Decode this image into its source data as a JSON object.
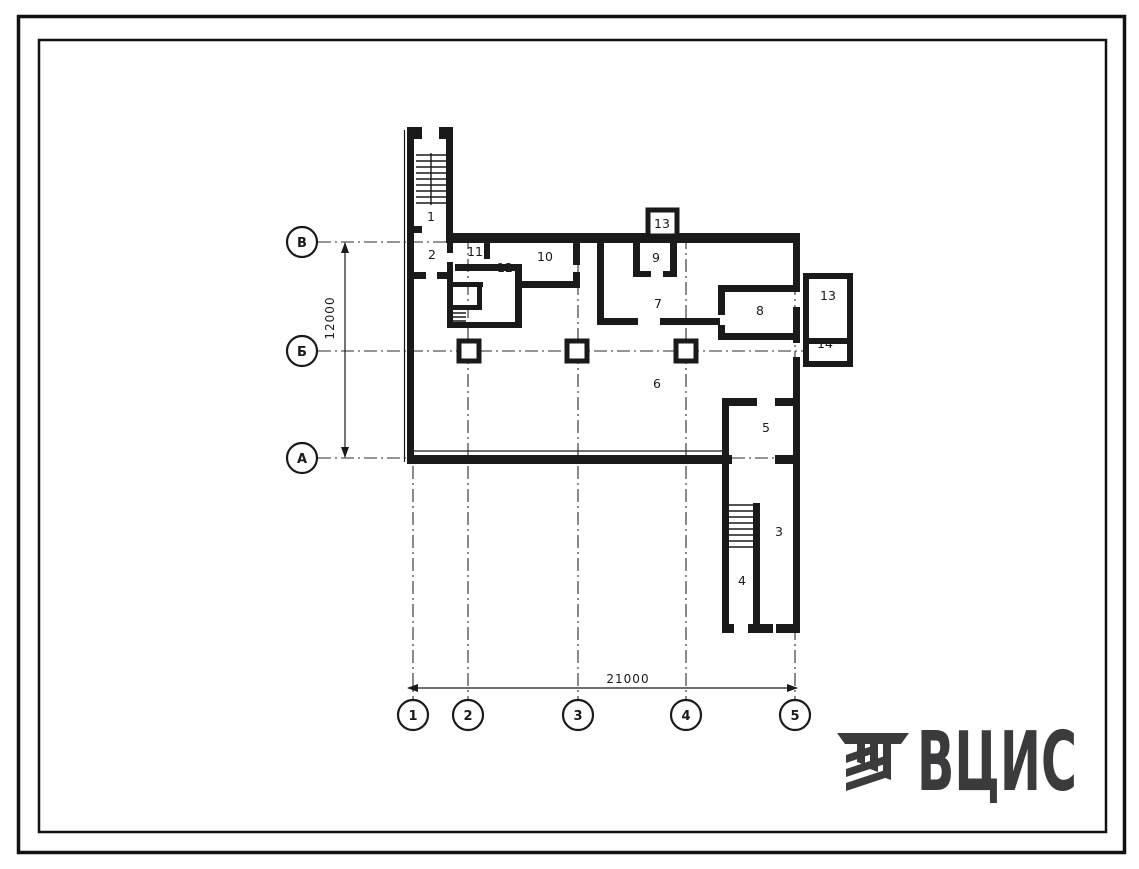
{
  "plan": {
    "rooms": [
      {
        "number": "1"
      },
      {
        "number": "2"
      },
      {
        "number": "11"
      },
      {
        "number": "12"
      },
      {
        "number": "10"
      },
      {
        "number": "13"
      },
      {
        "number": "9"
      },
      {
        "number": "7"
      },
      {
        "number": "8"
      },
      {
        "number": "13"
      },
      {
        "number": "14"
      },
      {
        "number": "6"
      },
      {
        "number": "5"
      },
      {
        "number": "3"
      },
      {
        "number": "4"
      }
    ],
    "row_axes": [
      {
        "label": "В"
      },
      {
        "label": "Б"
      },
      {
        "label": "А"
      }
    ],
    "col_axes": [
      {
        "label": "1"
      },
      {
        "label": "2"
      },
      {
        "label": "3"
      },
      {
        "label": "4"
      },
      {
        "label": "5"
      }
    ],
    "dimensions": {
      "horizontal": "21000",
      "vertical": "12000"
    }
  },
  "logo": {
    "text": "ВЦИС"
  },
  "colors": {
    "ink": "#1a1a1a",
    "paper": "#ffffff",
    "logo": "#3b3b3d"
  }
}
